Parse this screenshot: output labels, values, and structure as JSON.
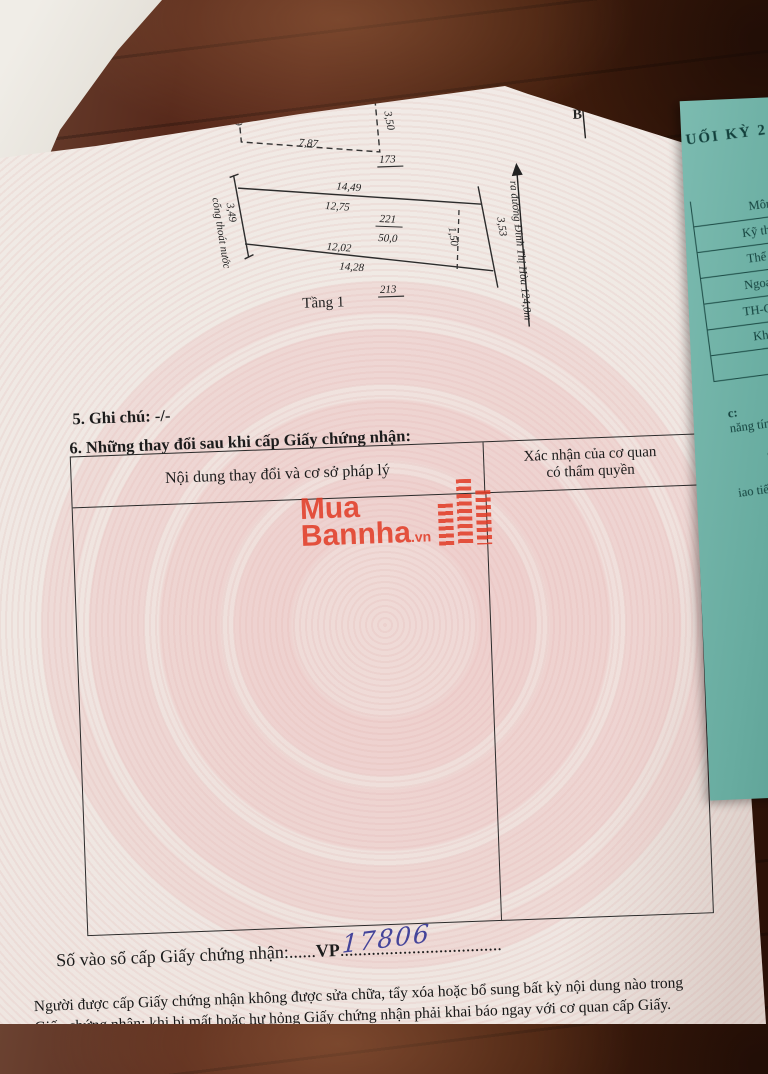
{
  "document": {
    "section4_title": "4. Sơ đồ thửa đất, tài sản gắn liền với đất:",
    "section5_line": "5. Ghi chú: -/-",
    "section6_title": "6. Những thay đổi sau khi cấp Giấy chứng nhận:",
    "register_label": "Số vào sổ cấp Giấy chứng nhận:",
    "register_dots_left": "......",
    "register_prefix": "VP",
    "register_number": "17806",
    "register_dots_right": "....................................",
    "note_line1": "Người được cấp Giấy chứng nhận không được sửa chữa, tẩy xóa hoặc bổ sung bất kỳ nội dung nào trong",
    "note_line2": "Giấy chứng nhận; khi bị mất hoặc hư hỏng Giấy chứng nhận phải khai báo ngay với cơ quan cấp Giấy."
  },
  "diagram": {
    "north_label": "B",
    "mezzanine": {
      "label": "Tầng lửng",
      "dim_top": "8,05",
      "dim_bottom": "7,87",
      "dim_left": "3,49",
      "dim_right": "3,50",
      "parcel_number": "173"
    },
    "floor1": {
      "label": "Tầng 1",
      "parcel_number": "213",
      "dim_top_outer": "14,49",
      "dim_top_inner": "12,75",
      "parcel_code": "221",
      "area": "50,0",
      "dim_bottom_inner": "12,02",
      "dim_bottom_outer": "14,28",
      "dim_dashed": "1,50",
      "dim_right": "3,53",
      "dim_left": "3,49",
      "left_note": "cống thoát nước",
      "road_label": "ra đường Đinh Thị Hòa 124,0m"
    }
  },
  "table": {
    "header_col1": "Nội dung thay đổi và cơ sở pháp lý",
    "header_col2_line1": "Xác nhận của cơ quan",
    "header_col2_line2": "có thẩm quyền"
  },
  "watermark": {
    "word1": "Mua",
    "word2": "Bannha",
    "suffix": ".vn"
  },
  "side_paper": {
    "header": "UỐI KỲ 2",
    "table_header": "Môn",
    "rows": [
      "Kỹ thuật",
      "Thể dục",
      "Ngoại ngữ",
      "TH-CN (Tin",
      "Khoa học",
      ""
    ],
    "fragments": [
      "c:",
      "năng tính t",
      "T",
      "T",
      "iao tiếp,",
      "T",
      "T",
      "ập và",
      "h Tiể"
    ]
  },
  "colors": {
    "paper": "#f0e9e4",
    "pattern_pink": "#e7aaaa",
    "teal_paper": "#6fb3a8",
    "wood_dark": "#3c1c12",
    "logo_red": "#e23a24",
    "pen_blue": "#44449a",
    "ink": "#1c1c1c"
  }
}
